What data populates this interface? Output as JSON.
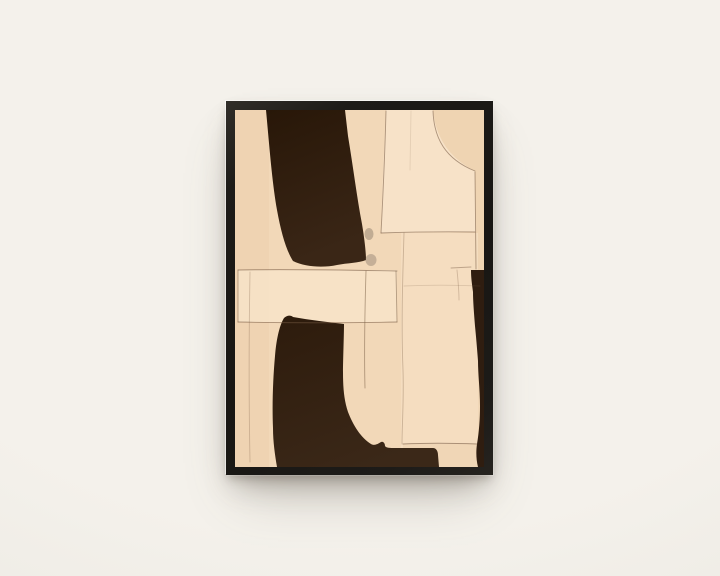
{
  "meta": {
    "scene": "Black-framed abstract art print hanging on a plain warm-white wall, soft drop shadow below",
    "text_content": "none"
  },
  "theme": {
    "wall-center": "#f4f1eb",
    "wall-edge": "#e9e6df",
    "frame-color": "#1d1b18"
  },
  "artwork": {
    "paper": "#f2d8b8",
    "panel_light": "#f8e6cd",
    "panel_warm": "#eccfab",
    "band_light": "#f8e5c9",
    "panel_right": "#f5dfc2",
    "brown_top": "#281708",
    "brown_mid": "#3a2616",
    "boot_top": "#2e1c0d",
    "boot_mid": "#3b2818",
    "strip_brown": "#2f1d10",
    "line": "#7a5e46",
    "smudge": "#8f7f6e",
    "elements": {
      "top_shape": "large dark curved band from top edge sweeping down-right",
      "bottom_shape": "dark boot-like shape with bottom band",
      "right_shape": "narrow dark strip along lower right edge",
      "details": "thin hand-drawn pencil lines forming rectangles and a quarter-circle arc"
    }
  }
}
